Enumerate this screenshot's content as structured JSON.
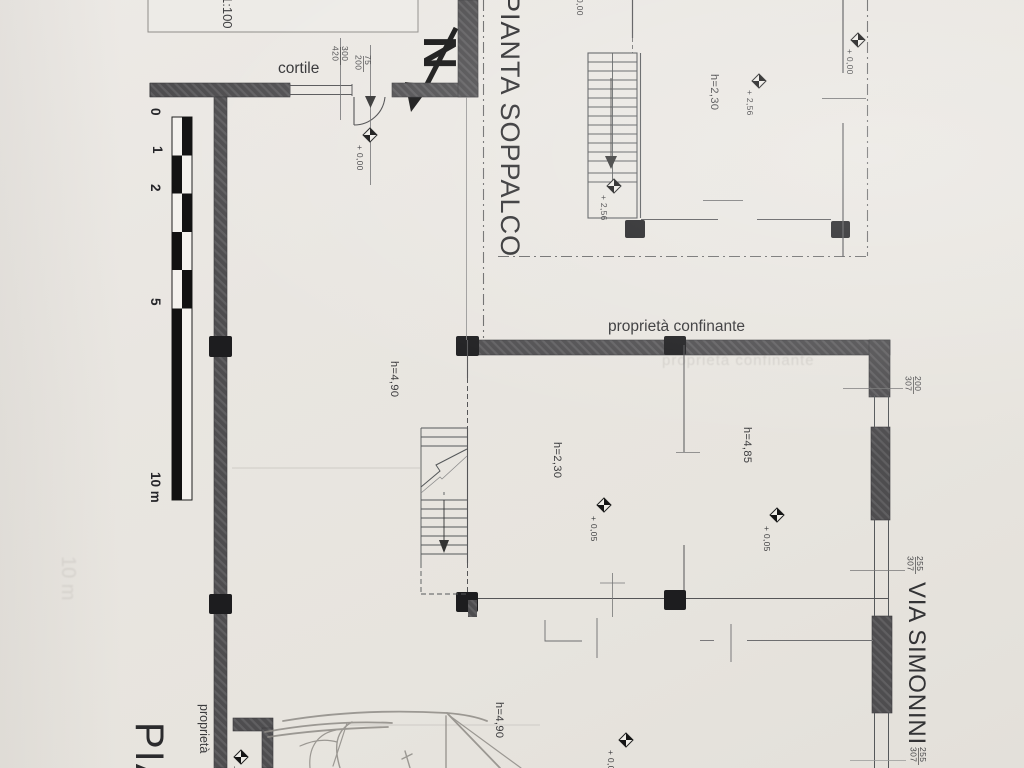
{
  "meta": {
    "scale": "1:100",
    "north": "N"
  },
  "labels": {
    "cortile": "cortile",
    "pianta_soppalco": "PIANTA SOPPALCO",
    "pianta_partial": "PIA",
    "via_simonini": "VIA SIMONINI",
    "prop_confinante": "proprietà confinante",
    "prop_left": "proprietà",
    "ghost_confinante": "proprietà confinante",
    "ghost_10m": "10 m"
  },
  "heights": {
    "mid_left": "h=4,90",
    "mid_center": "h=2,30",
    "mid_right": "h=4,85",
    "bottom": "h=4,90",
    "soppalco": "h=2,30"
  },
  "levels": {
    "door": "+ 0,00",
    "top_edge": "0,00",
    "soppalco_right": "+ 0,00",
    "soppalco_room": "+ 2,56",
    "stair_top": "+ 2,56",
    "mid_left": "+ 0,05",
    "mid_right": "+ 0,05",
    "bottom_room": "+ 0,00",
    "bottom_left": "+ 0,00"
  },
  "dimensions": {
    "d300_420": {
      "n": "300",
      "d": "420"
    },
    "d75_200": {
      "n": "75",
      "d": "200"
    },
    "d200_307": {
      "n": "200",
      "d": "307"
    },
    "d255_307": {
      "n": "255",
      "d": "307"
    },
    "d255_307_b": {
      "n": "255",
      "d": "307"
    }
  },
  "scalebar": {
    "l0": "0",
    "l1": "1",
    "l2": "2",
    "l5": "5",
    "l10": "10 m"
  },
  "colors": {
    "paper": "#e9e6e1",
    "wall": "#4e4d4f",
    "column": "#1d1d1f",
    "pencil": "#8e8b86"
  }
}
